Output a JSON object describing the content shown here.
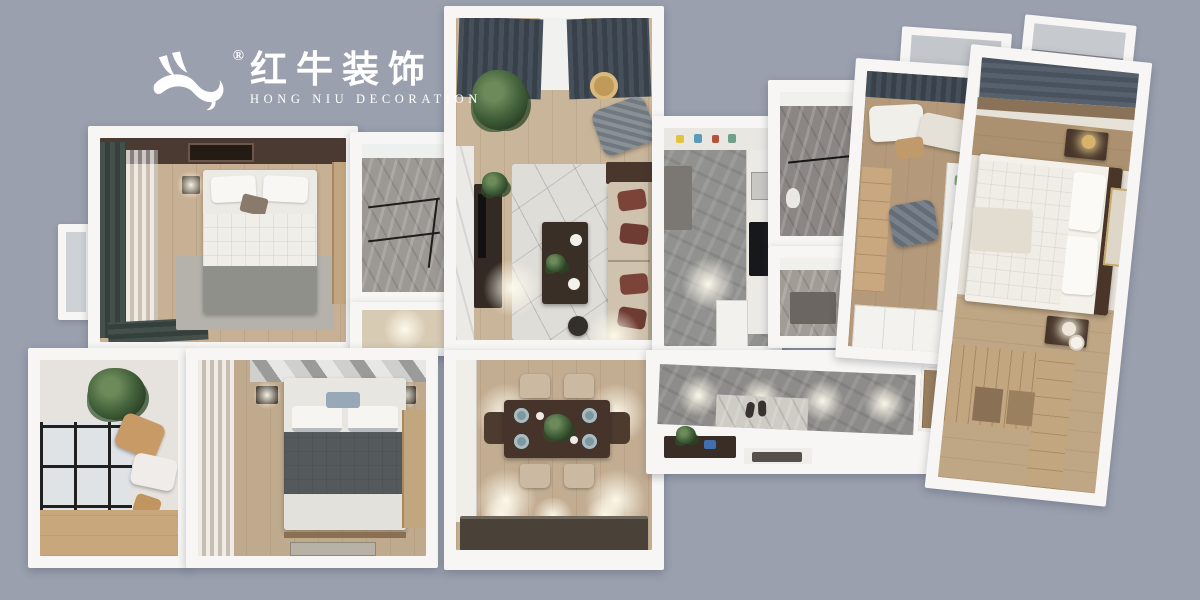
{
  "background_color": "#9aa0ae",
  "logo": {
    "icon": "bull-logo-icon",
    "registered_mark": "®",
    "chinese_name": "红牛装饰",
    "english_name": "HONG NIU DECORATION",
    "text_color": "#ffffff"
  },
  "scene": {
    "type": "3d-apartment-floorplan-top-down-render",
    "rooms": [
      "secondary-bedroom",
      "shower-room",
      "balcony-study",
      "third-bedroom",
      "living-room",
      "dining-room",
      "kitchen",
      "bathroom-large",
      "bathroom-small",
      "hallway-entry",
      "study-room",
      "master-bedroom",
      "balcony"
    ],
    "palette": {
      "wall": "#f7f6f4",
      "wood_floor": "#c9b59a",
      "stone_floor": "#8e8c8a",
      "dark_curtain": "#46505a",
      "green_curtain": "#414c48",
      "sofa_beige": "#cfc2ae",
      "accent_pillow": "#7c4339",
      "dark_wood": "#43332a",
      "wardrobe_wood": "#c2a67f",
      "blue_gray_curtain": "#5a6470",
      "rug": "#dfddd7"
    }
  }
}
